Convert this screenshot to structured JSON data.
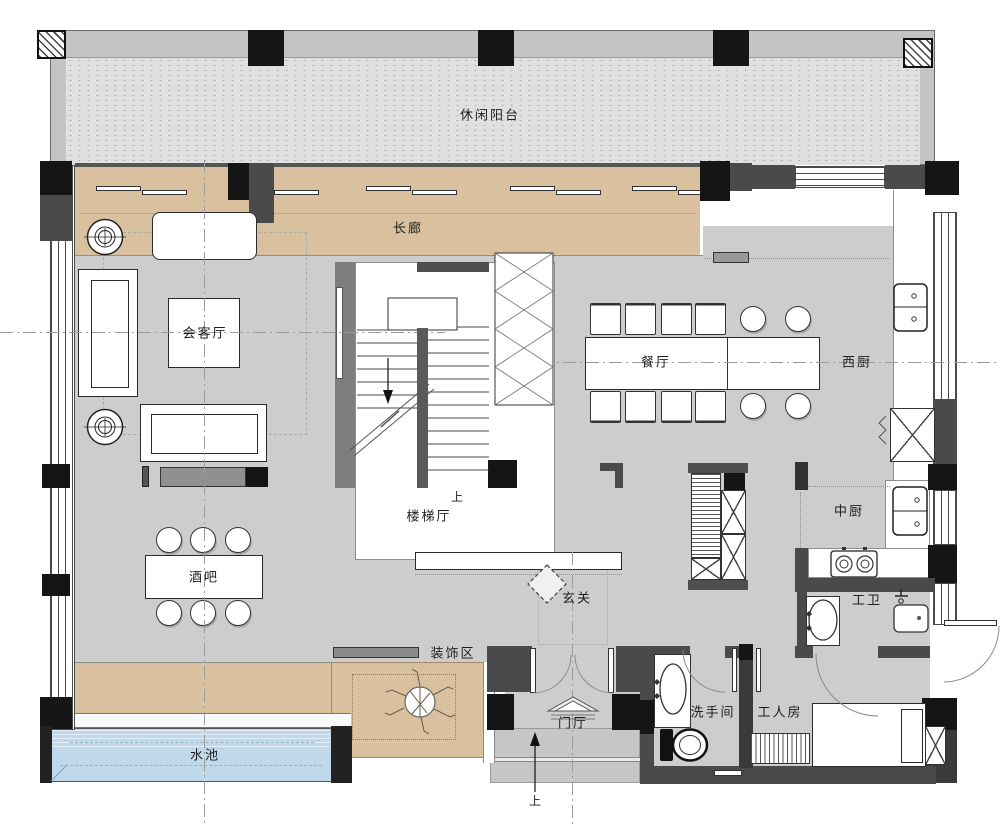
{
  "rooms": {
    "balcony": "休闲阳台",
    "gallery": "长廊",
    "reception": "会客厅",
    "dining": "餐厅",
    "west_kitchen": "西厨",
    "stair_hall": "楼梯厅",
    "middle_kitchen": "中厨",
    "bar": "酒吧",
    "entry": "玄关",
    "staff_bath": "工卫",
    "decor_zone": "装饰区",
    "washroom": "洗手间",
    "staff_room": "工人房",
    "foyer": "门厅",
    "pool": "水池"
  },
  "annotations": {
    "stair_up": "上",
    "entrance_up": "上"
  },
  "palette": {
    "floor_gray": "#cdcdcd",
    "deck_tan": "#d9c09e",
    "balcony_band_gray": "#c4c4c4",
    "balcony_floor_gray": "#e0e0e0",
    "pool_blue": "#bfd8ea",
    "wall_dark": "#4a4a4a",
    "column_black": "#151515"
  }
}
